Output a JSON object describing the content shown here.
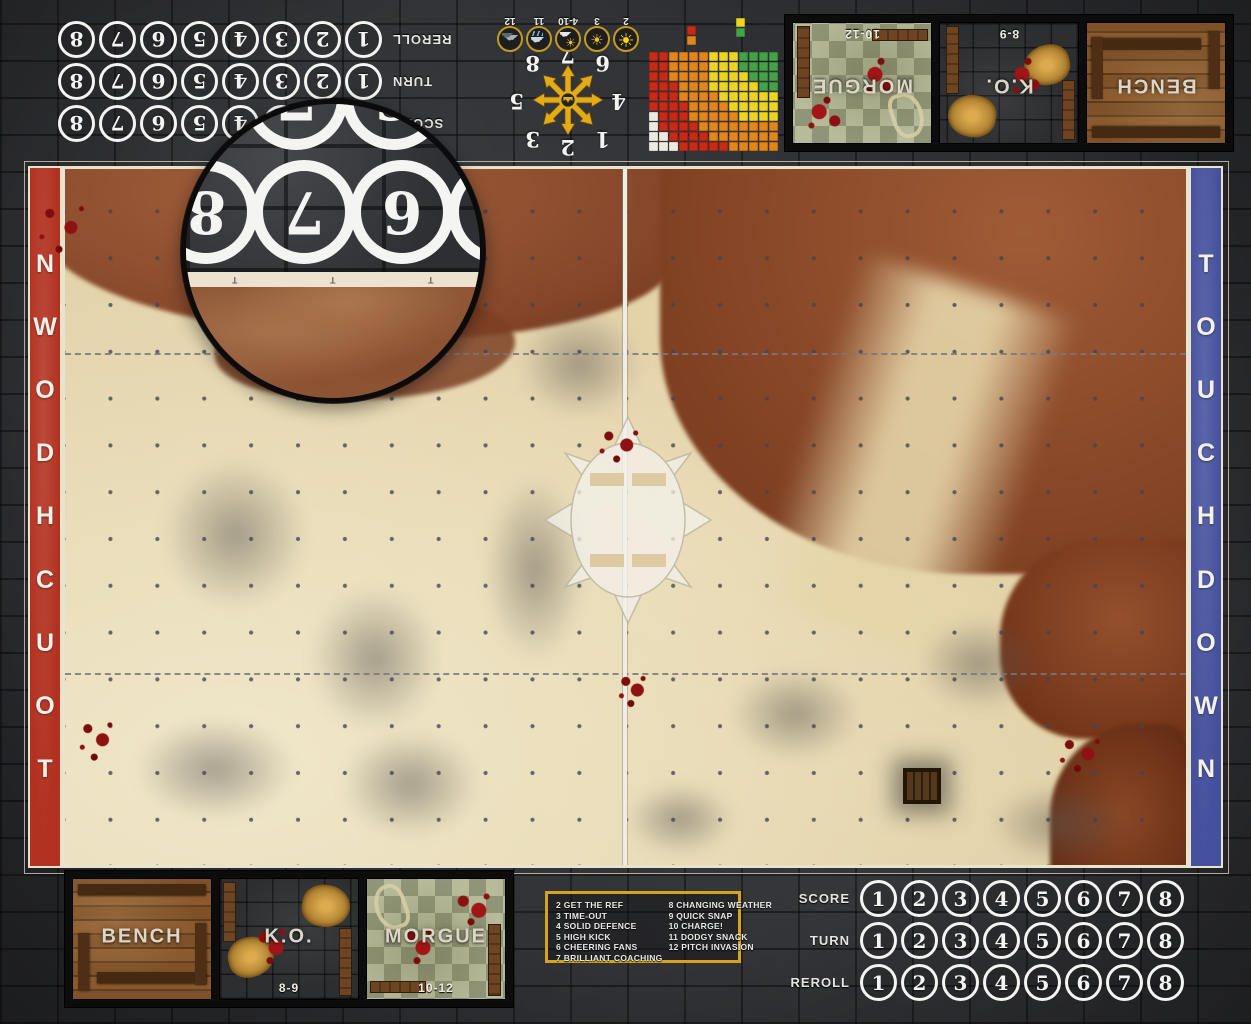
{
  "touchdown": {
    "label": "TOUCHDOWN",
    "left_color": "#b23120",
    "right_color": "#46519e"
  },
  "tracks": {
    "row_labels": [
      "SCORE",
      "TURN",
      "REROLL"
    ],
    "numbers": [
      "1",
      "2",
      "3",
      "4",
      "5",
      "6",
      "7",
      "8"
    ]
  },
  "dugouts": {
    "boxes": [
      {
        "id": "bench",
        "label": "BENCH",
        "range": "",
        "style": "wood"
      },
      {
        "id": "ko",
        "label": "K.O.",
        "range": "8-9",
        "style": "stone"
      },
      {
        "id": "morgue",
        "label": "MORGUE",
        "range": "10-12",
        "style": "tiles"
      }
    ]
  },
  "kickoff_table": {
    "left_column": [
      "2 GET THE REF",
      "3 TIME-OUT",
      "4 SOLID DEFENCE",
      "5 HIGH KICK",
      "6 CHEERING FANS",
      "7 BRILLIANT COACHING"
    ],
    "right_column": [
      "8 CHANGING WEATHER",
      "9 QUICK SNAP",
      "10 CHARGE!",
      "11 DODGY SNACK",
      "12 PITCH INVASION"
    ],
    "border_color": "#d7a31b"
  },
  "weather_track": {
    "entries": [
      {
        "label": "2",
        "icon": "blazing-sun-icon"
      },
      {
        "label": "3",
        "icon": "sun-icon"
      },
      {
        "label": "4-10",
        "icon": "partly-cloudy-icon"
      },
      {
        "label": "11",
        "icon": "rain-cloud-icon"
      },
      {
        "label": "12",
        "icon": "storm-clouds-icon"
      }
    ]
  },
  "scatter_template": {
    "numbers": [
      "1",
      "2",
      "3",
      "4",
      "5",
      "6",
      "7",
      "8"
    ]
  },
  "range_ruler": {
    "cols": 13,
    "rows": 10,
    "bands": [
      {
        "name": "quick-pass",
        "color": "#44a148",
        "max": 3.2
      },
      {
        "name": "short-pass",
        "color": "#ecd51f",
        "max": 6.8
      },
      {
        "name": "long-pass",
        "color": "#e28619",
        "max": 10.2
      },
      {
        "name": "long-bomb",
        "color": "#c92a16",
        "max": 13.4
      },
      {
        "name": "out-of-range",
        "color": "#ece9df",
        "max": 99
      }
    ]
  },
  "magnifier": {
    "main_numbers": [
      "8",
      "7",
      "6",
      "5"
    ],
    "partial_numbers": [
      "7",
      "6"
    ],
    "tick_marks": [
      "T",
      "T",
      "T"
    ]
  }
}
